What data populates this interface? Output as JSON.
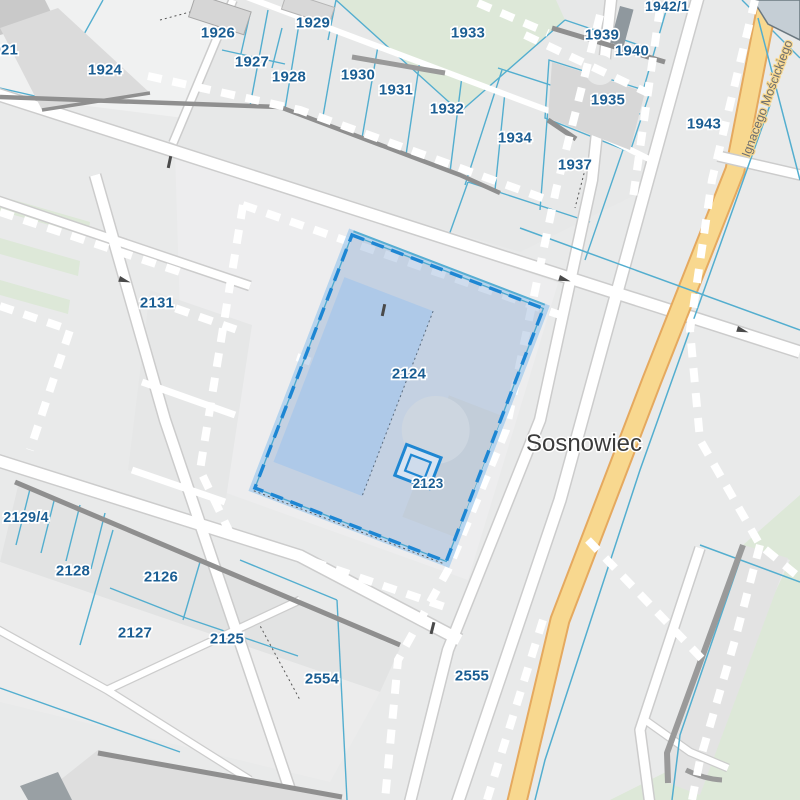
{
  "map": {
    "city_label": "Sosnowiec",
    "street_label": "Ignacego Mościckiego",
    "selection": {
      "selected_parcel": "2124",
      "inner_feature": "2123"
    },
    "colors": {
      "background": "#e9eaea",
      "parcel_line": "#53aecf",
      "selection_border": "#1d86d3",
      "selection_fill": "rgba(128,162,208,0.38)",
      "selected_building": "#aec9e8",
      "label_text": "#1b5e93",
      "road_fill": "#ffffff",
      "road_casing": "#cccccc",
      "yellow_road_fill": "#f8d88f",
      "yellow_road_casing": "#e5a95f",
      "green_area": "#dde8d8",
      "building": "#d8d8d8",
      "wall": "#8f8f8f",
      "city_text": "#3b3b3b",
      "street_text": "#6e6e6e"
    },
    "parcel_labels": [
      {
        "text": "1921",
        "x": 1,
        "y": 49,
        "size": 15
      },
      {
        "text": "1924",
        "x": 105,
        "y": 69,
        "size": 15
      },
      {
        "text": "1926",
        "x": 218,
        "y": 32,
        "size": 15
      },
      {
        "text": "1927",
        "x": 252,
        "y": 61,
        "size": 15
      },
      {
        "text": "1928",
        "x": 289,
        "y": 76,
        "size": 15
      },
      {
        "text": "1929",
        "x": 313,
        "y": 22,
        "size": 15
      },
      {
        "text": "1930",
        "x": 358,
        "y": 74,
        "size": 15
      },
      {
        "text": "1931",
        "x": 396,
        "y": 89,
        "size": 15
      },
      {
        "text": "1932",
        "x": 447,
        "y": 108,
        "size": 15
      },
      {
        "text": "1933",
        "x": 468,
        "y": 32,
        "size": 15
      },
      {
        "text": "1934",
        "x": 515,
        "y": 137,
        "size": 15
      },
      {
        "text": "1935",
        "x": 608,
        "y": 99,
        "size": 15
      },
      {
        "text": "1937",
        "x": 575,
        "y": 164,
        "size": 15
      },
      {
        "text": "1939",
        "x": 602,
        "y": 34,
        "size": 15
      },
      {
        "text": "1940",
        "x": 632,
        "y": 50,
        "size": 15
      },
      {
        "text": "1942/1",
        "x": 667,
        "y": 6,
        "size": 14
      },
      {
        "text": "1943",
        "x": 704,
        "y": 123,
        "size": 15
      },
      {
        "text": "2131",
        "x": 157,
        "y": 302,
        "size": 15
      },
      {
        "text": "2124",
        "x": 409,
        "y": 373,
        "size": 15
      },
      {
        "text": "2123",
        "x": 428,
        "y": 483,
        "size": 13.5
      },
      {
        "text": "2129/4",
        "x": 26,
        "y": 517,
        "size": 14.5
      },
      {
        "text": "2128",
        "x": 73,
        "y": 570,
        "size": 15
      },
      {
        "text": "2126",
        "x": 161,
        "y": 576,
        "size": 15
      },
      {
        "text": "2127",
        "x": 135,
        "y": 632,
        "size": 15
      },
      {
        "text": "2125",
        "x": 227,
        "y": 638,
        "size": 15
      },
      {
        "text": "2554",
        "x": 322,
        "y": 678,
        "size": 15
      },
      {
        "text": "2555",
        "x": 472,
        "y": 675,
        "size": 15
      }
    ]
  }
}
